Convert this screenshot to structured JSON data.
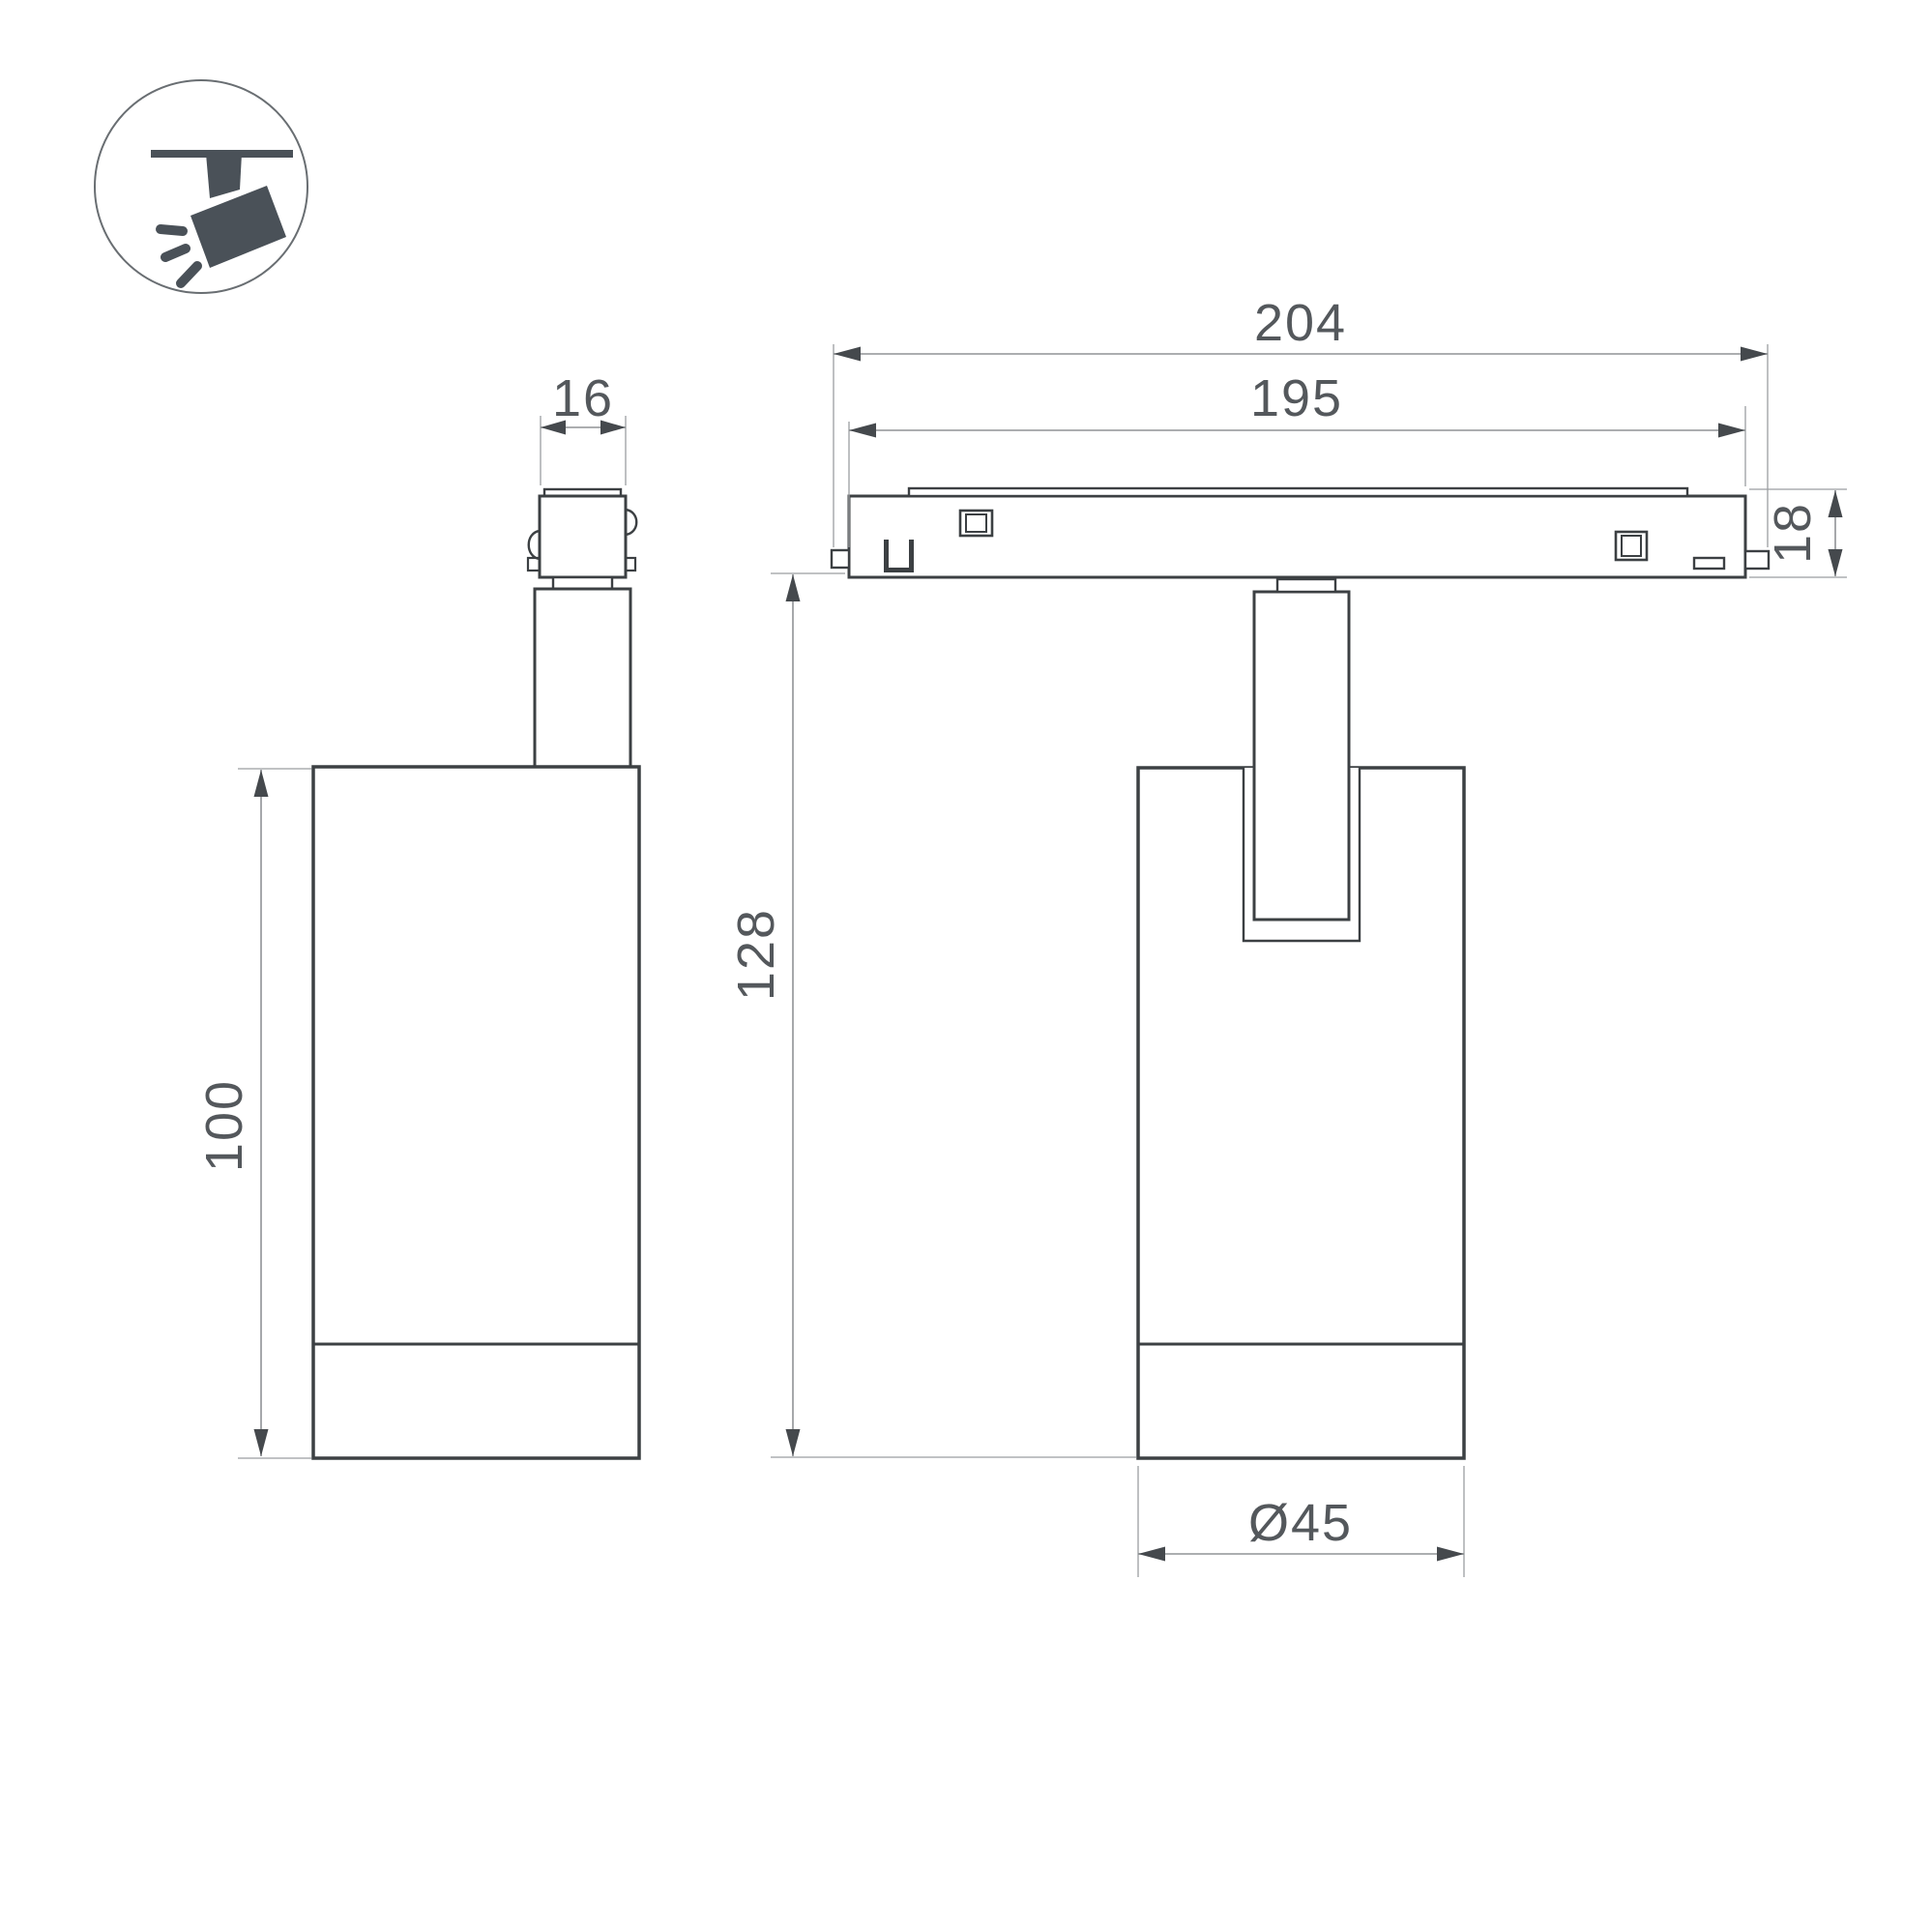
{
  "icon": {
    "name": "ceiling-track-spotlight-pictogram"
  },
  "colors": {
    "background": "#ffffff",
    "object_outline": "#3c4043",
    "dimension_line": "#909396",
    "arrow": "#45494d",
    "label_text": "#54585c",
    "icon_fill": "#4a5158",
    "icon_circle_stroke": "#696e72"
  },
  "dimensions": {
    "track_total_length_mm": {
      "label": "204"
    },
    "track_visible_length_mm": {
      "label": "195"
    },
    "adapter_width_mm": {
      "label": "16"
    },
    "track_height_mm": {
      "label": "18"
    },
    "overall_height_mm": {
      "label": "128"
    },
    "body_height_mm": {
      "label": "100"
    },
    "body_diameter_mm": {
      "label": "Ø45"
    }
  }
}
